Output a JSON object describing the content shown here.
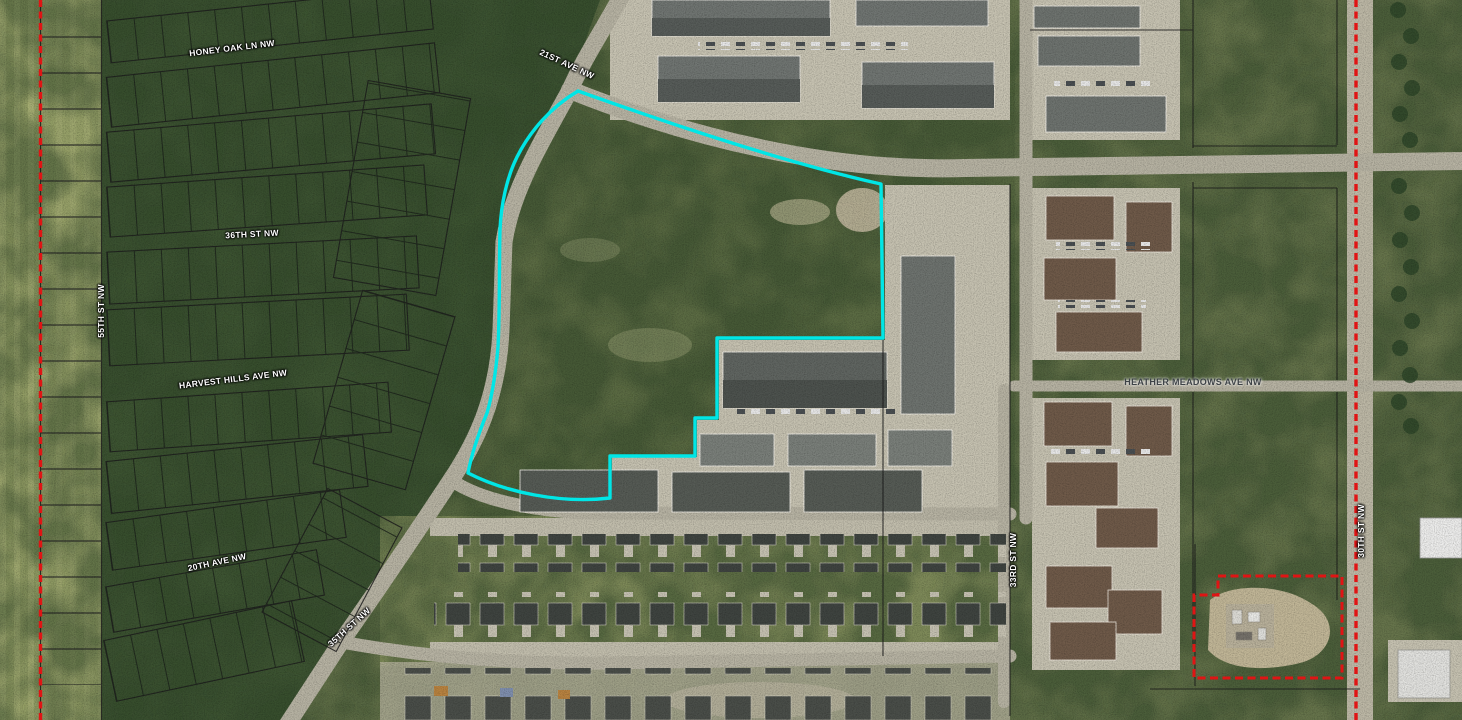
{
  "map": {
    "title": "Aerial parcel map with highlighted parcel",
    "street_labels": [
      {
        "id": "honey-oak-ln-nw",
        "text": "HONEY OAK LN NW"
      },
      {
        "id": "36th-st-nw",
        "text": "36TH ST NW"
      },
      {
        "id": "55th-st-nw",
        "text": "55TH ST NW"
      },
      {
        "id": "harvest-hills-ave-nw",
        "text": "HARVEST HILLS AVE NW"
      },
      {
        "id": "20th-ave-nw",
        "text": "20TH AVE NW"
      },
      {
        "id": "35th-st-nw",
        "text": "35TH ST NW"
      },
      {
        "id": "21st-ave-nw",
        "text": "21ST AVE NW"
      },
      {
        "id": "heather-meadows-ave-nw",
        "text": "HEATHER MEADOWS AVE NW"
      },
      {
        "id": "33rd-st-nw",
        "text": "33RD ST NW"
      },
      {
        "id": "30th-st-nw",
        "text": "30TH ST NW"
      }
    ],
    "overlays": {
      "selected_parcel_outline_color": "#00e6e6",
      "boundary_line_color": "#e01414",
      "parcel_line_color": "#1d1d1d"
    }
  }
}
